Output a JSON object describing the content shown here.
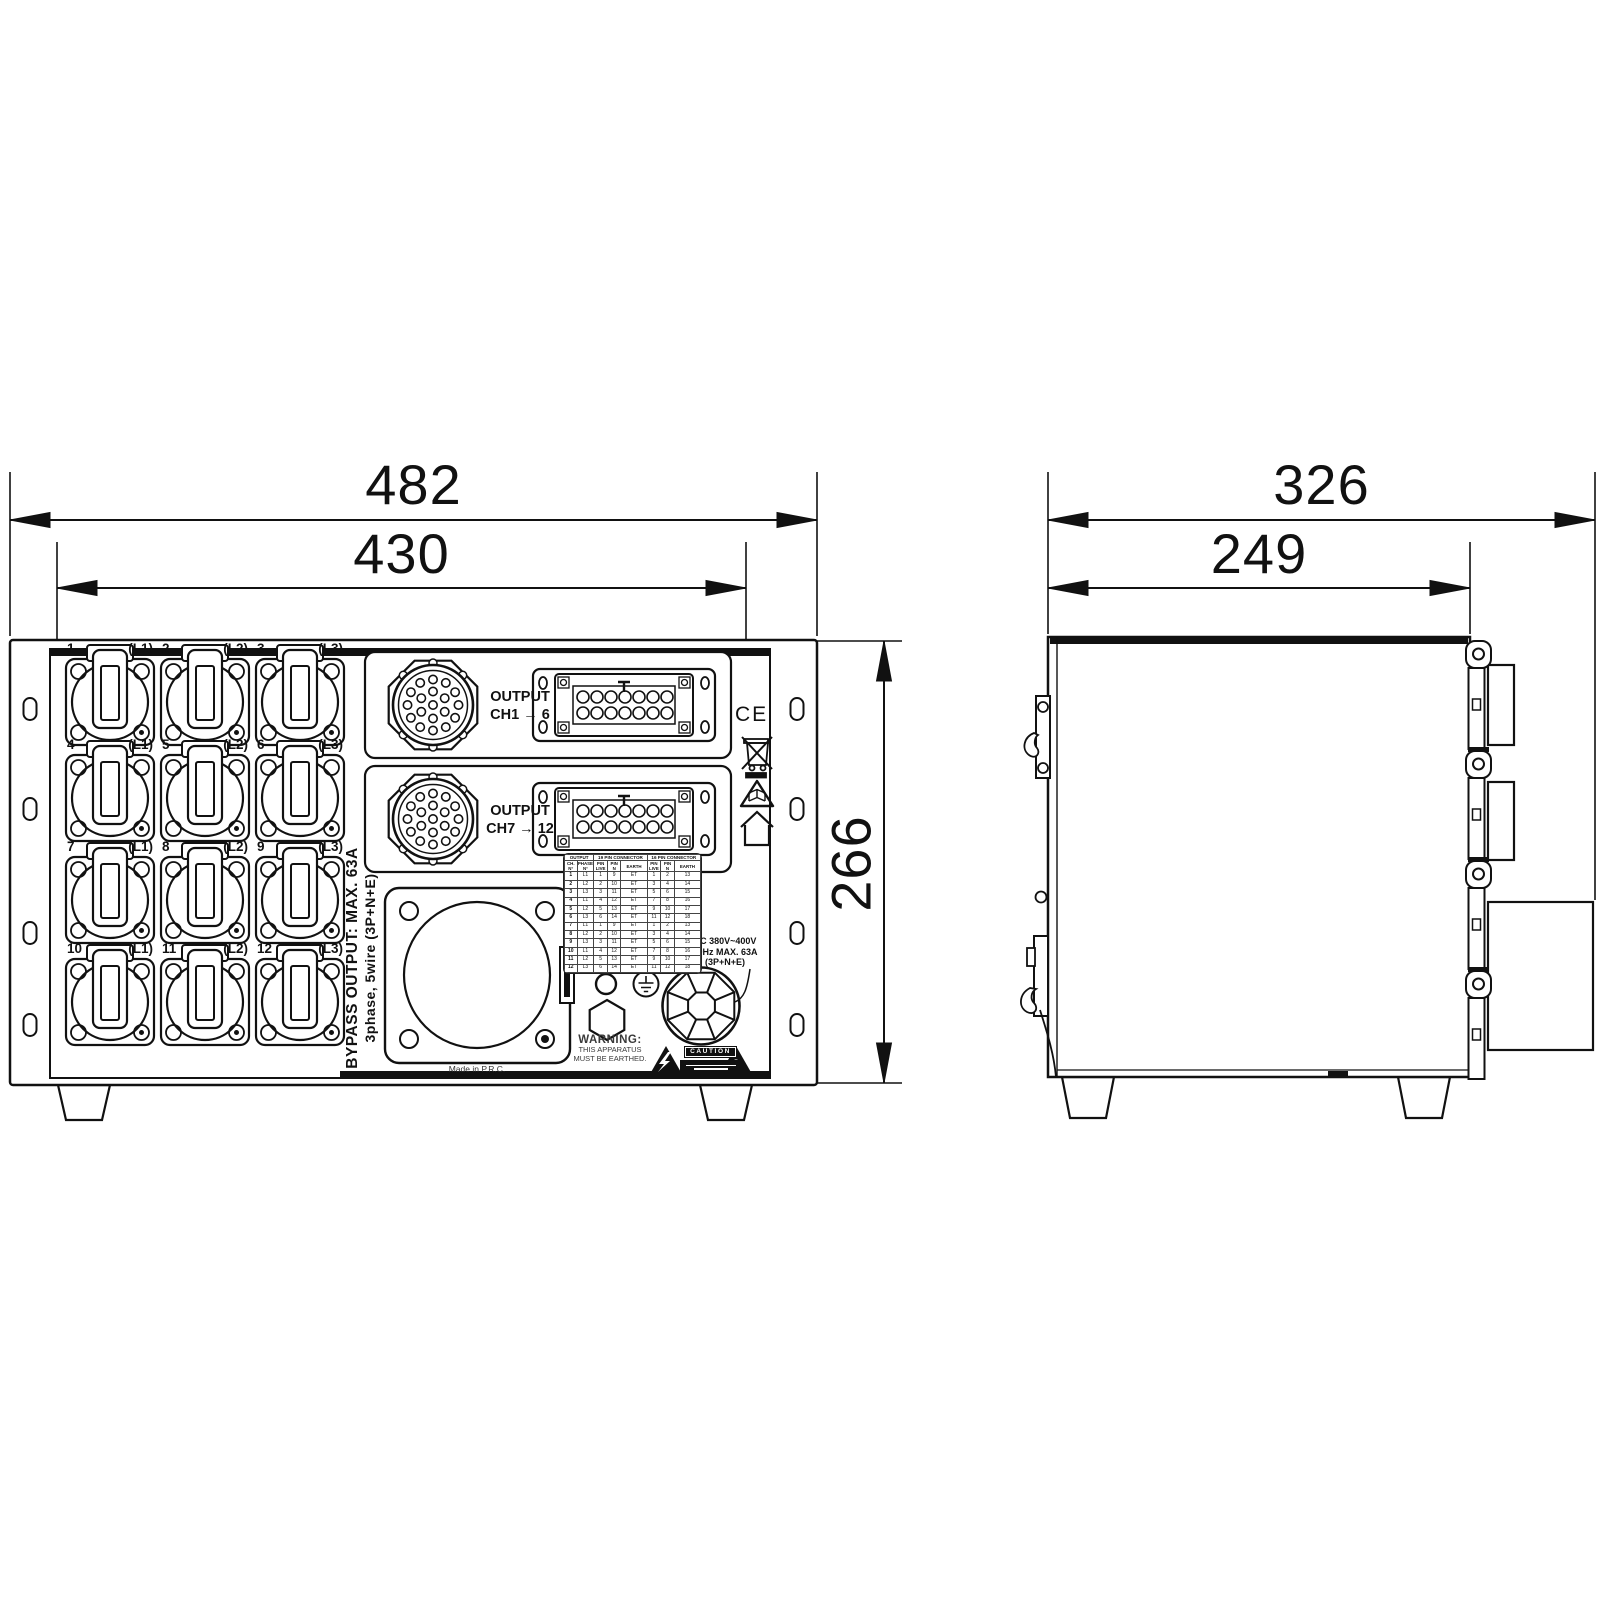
{
  "dimensions": {
    "front_width_outer": "482",
    "front_width_inner": "430",
    "front_height": "266",
    "side_depth_outer": "326",
    "side_depth_inner": "249"
  },
  "front": {
    "sockets": [
      {
        "num": "1",
        "phase": "(L1)"
      },
      {
        "num": "2",
        "phase": "(L2)"
      },
      {
        "num": "3",
        "phase": "(L3)"
      },
      {
        "num": "4",
        "phase": "(L1)"
      },
      {
        "num": "5",
        "phase": "(L2)"
      },
      {
        "num": "6",
        "phase": "(L3)"
      },
      {
        "num": "7",
        "phase": "(L1)"
      },
      {
        "num": "8",
        "phase": "(L2)"
      },
      {
        "num": "9",
        "phase": "(L3)"
      },
      {
        "num": "10",
        "phase": "(L1)"
      },
      {
        "num": "11",
        "phase": "(L2)"
      },
      {
        "num": "12",
        "phase": "(L3)"
      }
    ],
    "outputs": [
      {
        "line1": "OUTPUT",
        "line2": "CH1 → 6"
      },
      {
        "line1": "OUTPUT",
        "line2": "CH7 → 12"
      }
    ],
    "ce_mark": "CE",
    "bypass_label": {
      "line1": "BYPASS OUTPUT: MAX. 63A",
      "line2": "3phase, 5wire (3P+N+E)"
    },
    "warning": {
      "l1": "WARNING:",
      "l2": "THIS APPARATUS",
      "l3": "MUST BE EARTHED."
    },
    "caution_label": "CAUTION",
    "ac_rating": {
      "l1": "AC 380V~400V",
      "l2": "50Hz MAX. 63A",
      "l3": "(3P+N+E)"
    },
    "made_in": "Made in P.R.C."
  },
  "pin_table": {
    "group_headers": [
      "OUTPUT",
      "19 PIN CONNECTOR",
      "16 PIN CONNECTOR"
    ],
    "col_headers": [
      "CH.\nN°",
      "PHASE\nN°",
      "PIN\nLIVE",
      "PIN\nN",
      "EARTH",
      "PIN\nLIVE",
      "PIN\nN",
      "EARTH"
    ],
    "rows": [
      [
        "1",
        "L1",
        "1",
        "9",
        "ET",
        "1",
        "2",
        "13"
      ],
      [
        "2",
        "L2",
        "2",
        "10",
        "ET",
        "3",
        "4",
        "14"
      ],
      [
        "3",
        "L3",
        "3",
        "11",
        "ET",
        "5",
        "6",
        "15"
      ],
      [
        "4",
        "L1",
        "4",
        "12",
        "ET",
        "7",
        "8",
        "16"
      ],
      [
        "5",
        "L2",
        "5",
        "13",
        "ET",
        "9",
        "10",
        "17"
      ],
      [
        "6",
        "L3",
        "6",
        "14",
        "ET",
        "11",
        "12",
        "18"
      ],
      [
        "7",
        "L1",
        "1",
        "9",
        "ET",
        "1",
        "2",
        "13"
      ],
      [
        "8",
        "L2",
        "2",
        "10",
        "ET",
        "3",
        "4",
        "14"
      ],
      [
        "9",
        "L3",
        "3",
        "11",
        "ET",
        "5",
        "6",
        "15"
      ],
      [
        "10",
        "L1",
        "4",
        "12",
        "ET",
        "7",
        "8",
        "16"
      ],
      [
        "11",
        "L2",
        "5",
        "13",
        "ET",
        "9",
        "10",
        "17"
      ],
      [
        "12",
        "L3",
        "6",
        "14",
        "ET",
        "11",
        "12",
        "18"
      ]
    ]
  }
}
